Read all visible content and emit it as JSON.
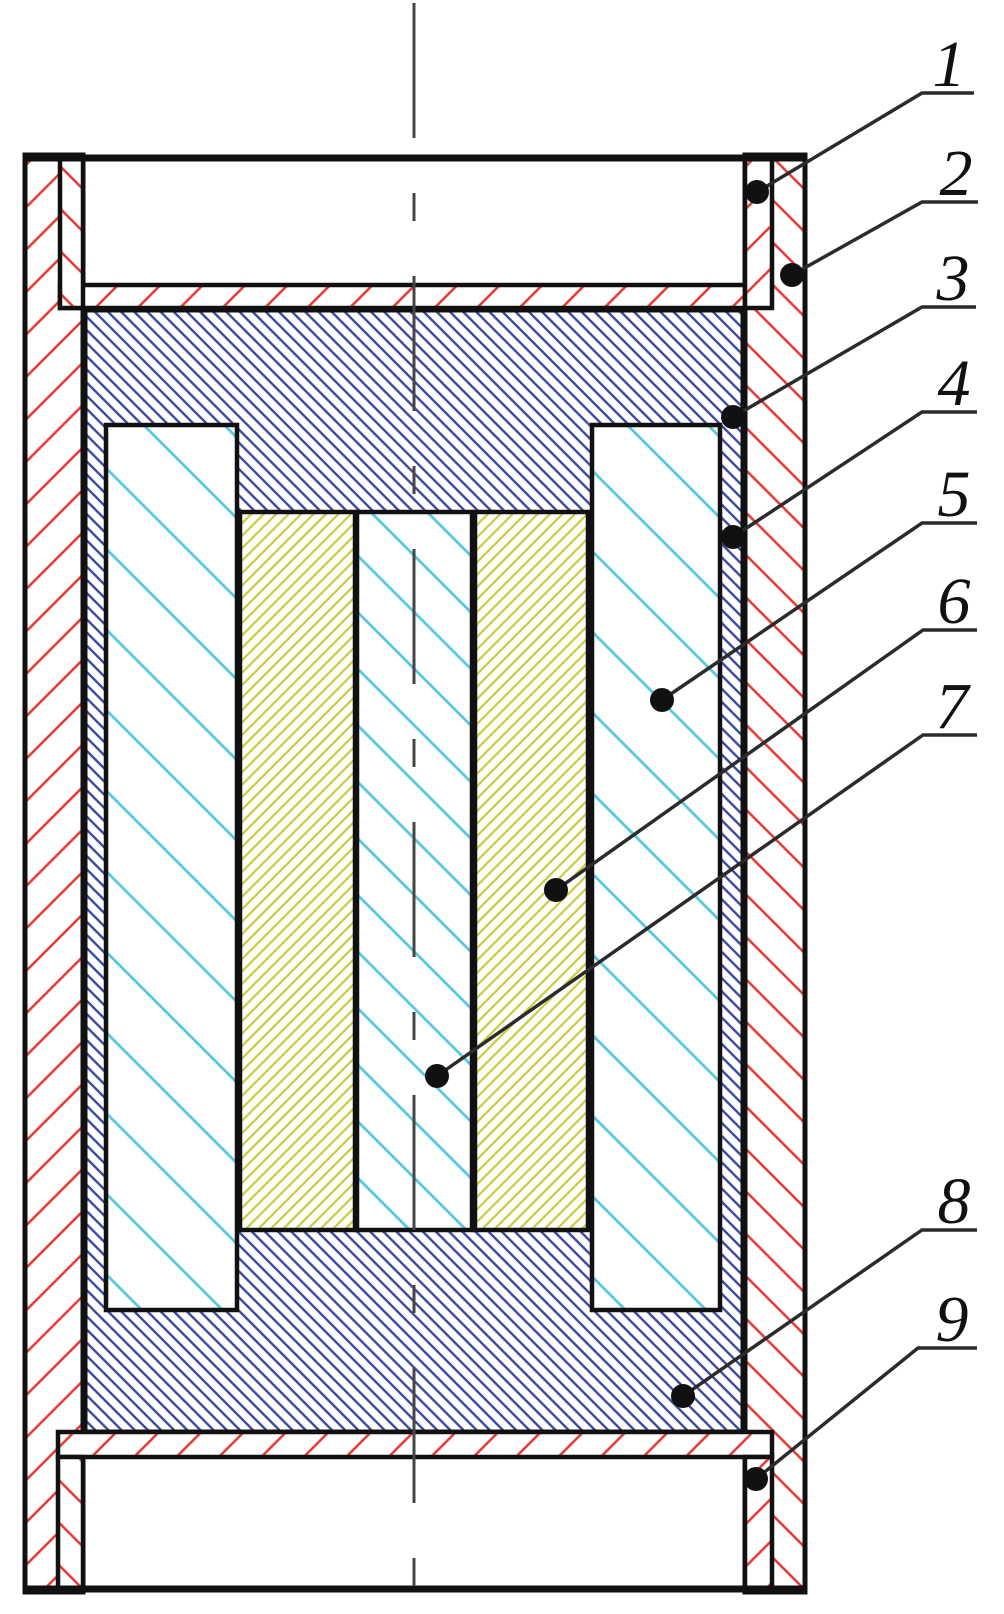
{
  "diagram": {
    "kind": "sectional-assembly-technical-drawing",
    "labels": [
      {
        "id": "1",
        "text": "1"
      },
      {
        "id": "2",
        "text": "2"
      },
      {
        "id": "3",
        "text": "3"
      },
      {
        "id": "4",
        "text": "4"
      },
      {
        "id": "5",
        "text": "5"
      },
      {
        "id": "6",
        "text": "6"
      },
      {
        "id": "7",
        "text": "7"
      },
      {
        "id": "8",
        "text": "8"
      },
      {
        "id": "9",
        "text": "9"
      }
    ],
    "colors": {
      "shell_hatch_red": "#e63832",
      "block_hatch_blue": "#3b4aa0",
      "column_hatch_cyan": "#55c8e0",
      "insert_hatch_yellow": "#c9cc3a",
      "outline_black": "#111111",
      "leader_line": "#2b2b2b"
    }
  }
}
